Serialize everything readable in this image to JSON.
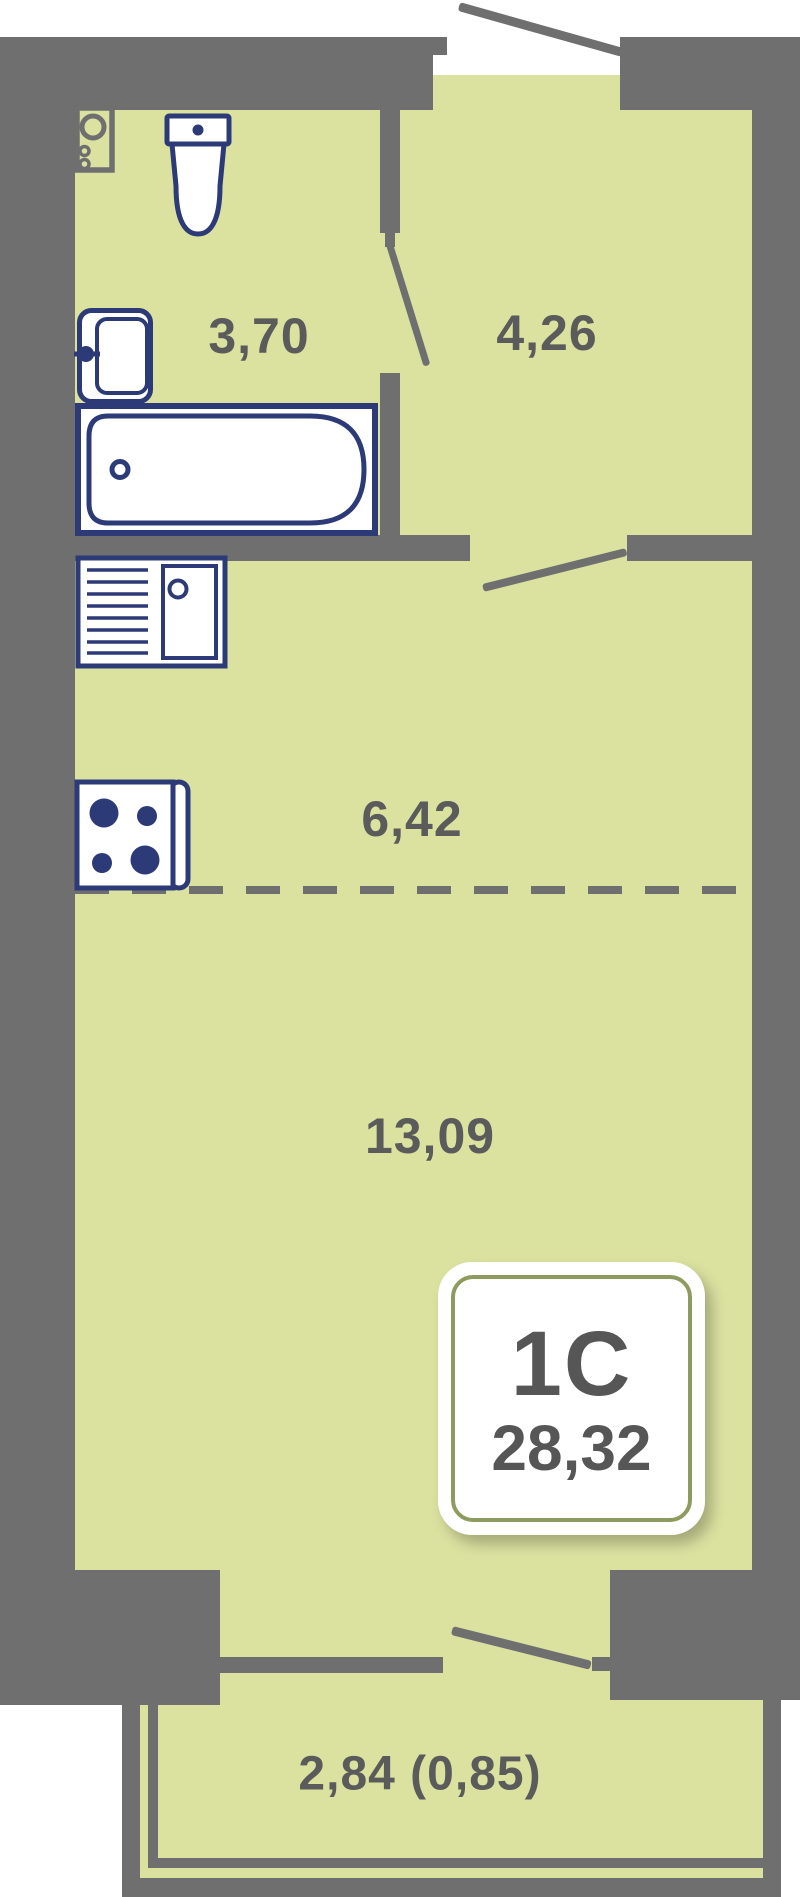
{
  "unit": {
    "type_label": "1С",
    "total_area": "28,32"
  },
  "rooms": {
    "bathroom": {
      "area": "3,70"
    },
    "hallway": {
      "area": "4,26"
    },
    "kitchen": {
      "area": "6,42"
    },
    "living_room": {
      "area": "13,09"
    },
    "balcony": {
      "area": "2,84 (0,85)"
    }
  },
  "colors": {
    "wall": "#6f6f6f",
    "floor": "#dbe2a0",
    "fixture_outline": "#2c3a78",
    "label_text": "#5b5b5b",
    "badge_ring": "#8d9b5e",
    "badge_background": "#ffffff",
    "page_background": "#ffffff"
  }
}
